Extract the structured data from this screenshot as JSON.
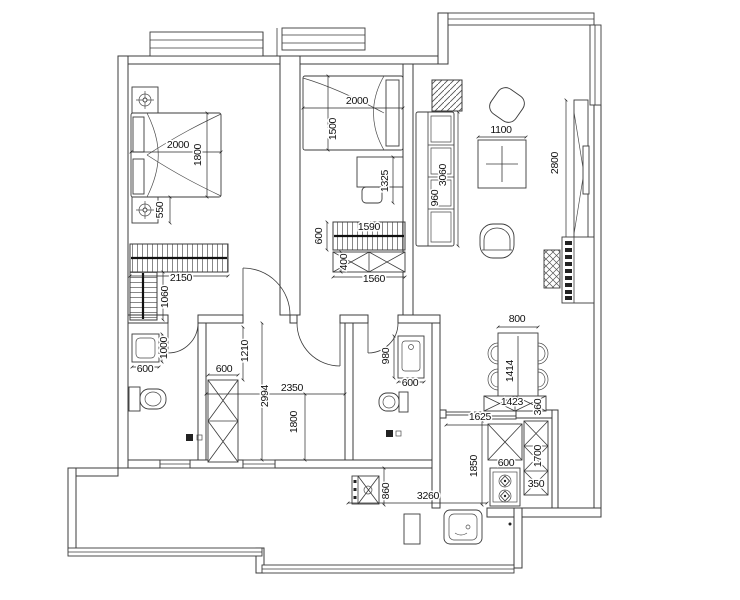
{
  "page": {
    "background": "#ffffff",
    "drawing_type": "residential-floor-plan"
  },
  "drawing": {
    "line_color": "#3b3b3b",
    "dim_color": "#111111",
    "dimension_labels": [
      {
        "text": "2000",
        "x": 178,
        "y": 148,
        "rot": 0
      },
      {
        "text": "1800",
        "x": 201,
        "y": 155,
        "rot": -90
      },
      {
        "text": "550",
        "x": 163,
        "y": 210,
        "rot": -90
      },
      {
        "text": "2150",
        "x": 181,
        "y": 281,
        "rot": 0
      },
      {
        "text": "1060",
        "x": 168,
        "y": 297,
        "rot": -90
      },
      {
        "text": "1000",
        "x": 167,
        "y": 348,
        "rot": -90
      },
      {
        "text": "600",
        "x": 145,
        "y": 372,
        "rot": 0
      },
      {
        "text": "2000",
        "x": 357,
        "y": 104,
        "rot": 0
      },
      {
        "text": "1500",
        "x": 336,
        "y": 129,
        "rot": -90
      },
      {
        "text": "1325",
        "x": 388,
        "y": 181,
        "rot": -90
      },
      {
        "text": "600",
        "x": 322,
        "y": 236,
        "rot": -90
      },
      {
        "text": "1590",
        "x": 369,
        "y": 230,
        "rot": 0
      },
      {
        "text": "400",
        "x": 347,
        "y": 262,
        "rot": -90
      },
      {
        "text": "1560",
        "x": 374,
        "y": 282,
        "rot": 0
      },
      {
        "text": "600",
        "x": 224,
        "y": 372,
        "rot": 0
      },
      {
        "text": "1210",
        "x": 248,
        "y": 351,
        "rot": -90
      },
      {
        "text": "2994",
        "x": 268,
        "y": 396,
        "rot": -90
      },
      {
        "text": "2350",
        "x": 292,
        "y": 391,
        "rot": 0
      },
      {
        "text": "1800",
        "x": 297,
        "y": 422,
        "rot": -90
      },
      {
        "text": "980",
        "x": 389,
        "y": 356,
        "rot": -90
      },
      {
        "text": "600",
        "x": 410,
        "y": 386,
        "rot": 0
      },
      {
        "text": "3060",
        "x": 446,
        "y": 175,
        "rot": -90
      },
      {
        "text": "960",
        "x": 438,
        "y": 198,
        "rot": -90
      },
      {
        "text": "1100",
        "x": 501,
        "y": 133,
        "rot": 0
      },
      {
        "text": "2800",
        "x": 558,
        "y": 163,
        "rot": -90
      },
      {
        "text": "800",
        "x": 517,
        "y": 322,
        "rot": 0
      },
      {
        "text": "1414",
        "x": 513,
        "y": 371,
        "rot": -90
      },
      {
        "text": "1423",
        "x": 512,
        "y": 405,
        "rot": 0
      },
      {
        "text": "360",
        "x": 541,
        "y": 407,
        "rot": -90
      },
      {
        "text": "1625",
        "x": 480,
        "y": 420,
        "rot": 0
      },
      {
        "text": "600",
        "x": 506,
        "y": 466,
        "rot": 0
      },
      {
        "text": "1850",
        "x": 477,
        "y": 466,
        "rot": -90
      },
      {
        "text": "1700",
        "x": 541,
        "y": 456,
        "rot": -90
      },
      {
        "text": "350",
        "x": 536,
        "y": 487,
        "rot": 0
      },
      {
        "text": "860",
        "x": 389,
        "y": 491,
        "rot": -90
      },
      {
        "text": "3260",
        "x": 428,
        "y": 499,
        "rot": 0
      }
    ]
  }
}
